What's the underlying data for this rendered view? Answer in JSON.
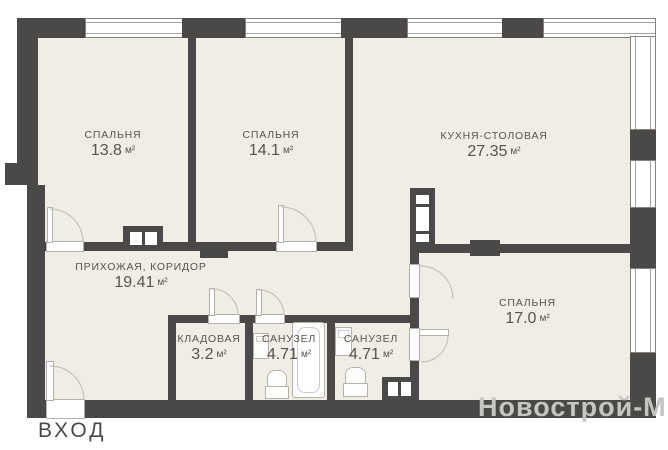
{
  "plan": {
    "rooms": {
      "bedroom1": {
        "name": "СПАЛЬНЯ",
        "area": "13.8",
        "unit": "м²"
      },
      "bedroom2": {
        "name": "СПАЛЬНЯ",
        "area": "14.1",
        "unit": "м²"
      },
      "kitchen": {
        "name": "КУХНЯ-СТОЛОВАЯ",
        "area": "27.35",
        "unit": "м²"
      },
      "hallway": {
        "name": "ПРИХОЖАЯ, КОРИДОР",
        "area": "19.41",
        "unit": "м²"
      },
      "storage": {
        "name": "КЛАДОВАЯ",
        "area": "3.2",
        "unit": "м²"
      },
      "bathroom1": {
        "name": "САНУЗЕЛ",
        "area": "4.71",
        "unit": "м²"
      },
      "bathroom2": {
        "name": "САНУЗЕЛ",
        "area": "4.71",
        "unit": "м²"
      },
      "bedroom3": {
        "name": "СПАЛЬНЯ",
        "area": "17.0",
        "unit": "м²"
      }
    },
    "entrance_label": "ВХОД",
    "watermark": "Новострой-М",
    "colors": {
      "wall": "#4a4947",
      "room_fill": "#f0ede7",
      "text": "#56534e",
      "watermark": "#c7c5c2"
    }
  }
}
